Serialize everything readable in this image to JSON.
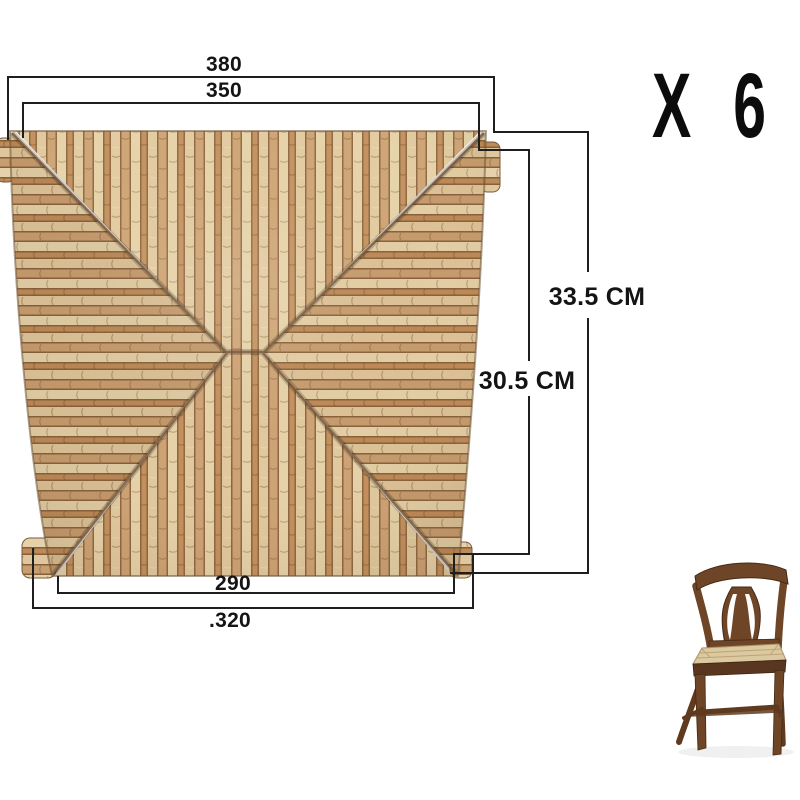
{
  "diagram": {
    "quantity_label": "X 6",
    "labels": {
      "top_outer": "380",
      "top_inner": "350",
      "side_outer": "33.5 CM",
      "side_inner": "30.5 CM",
      "bottom_inner": "290",
      "bottom_outer": ".320"
    },
    "images": {
      "seat": "woven-rush-chair-seat-top-view",
      "chair": "wooden-chair-with-rush-seat"
    },
    "colors": {
      "background": "#ffffff",
      "dimension_line": "#1e1e1e",
      "label_text": "#141414",
      "rush_light": "#e8d6ae",
      "rush_mid": "#cea476",
      "rush_dark": "#c3905e",
      "rush_groove": "#8a6540",
      "wood_dark": "#6e4526",
      "wood_shadow": "#452a15"
    }
  }
}
